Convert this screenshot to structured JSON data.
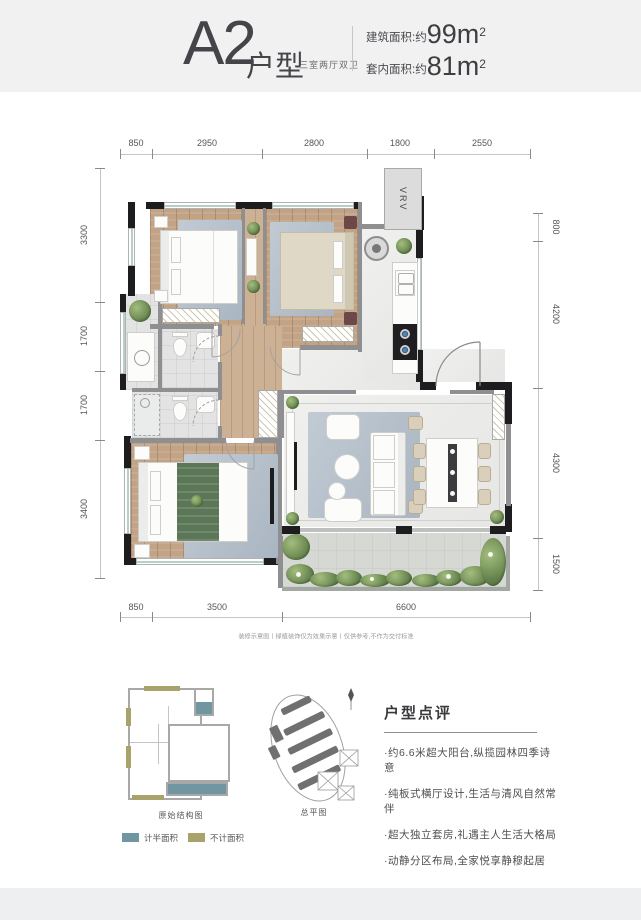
{
  "header": {
    "title": "A2",
    "title_suffix": "户型",
    "subtitle": "三室两厅双卫",
    "area_items": [
      {
        "label": "建筑面积:约",
        "value": "99m",
        "sup": "2"
      },
      {
        "label": "套内面积:约",
        "value": "81m",
        "sup": "2"
      }
    ]
  },
  "plan": {
    "vrv_label": "VRV",
    "dims_top": [
      "850",
      "2950",
      "2800",
      "1800",
      "2550"
    ],
    "dims_left": [
      "3300",
      "1700",
      "1700",
      "3400"
    ],
    "dims_right": [
      "800",
      "4200",
      "4300",
      "1500"
    ],
    "dims_bottom": [
      "850",
      "3500",
      "6600"
    ],
    "disclaimer": "装修示意图丨绿植装饰仅为效果示意丨仅供参考,不作为交付标准"
  },
  "footer": {
    "structure_label": "原始结构图",
    "site_label": "总平图",
    "legend": [
      {
        "label": "计半面积",
        "color": "#7097a1"
      },
      {
        "label": "不计面积",
        "color": "#a9a26b"
      }
    ],
    "review_title": "户型点评",
    "review_bullets": [
      "·约6.6米超大阳台,纵揽园林四季诗意",
      "·纯板式横厅设计,生活与清风自然常伴",
      "·超大独立套房,礼遇主人生活大格局",
      "·动静分区布局,全家悦享静穆起居"
    ]
  },
  "colors": {
    "accent_teal": "#7097a1",
    "accent_olive": "#a9a26b",
    "wall": "#1d1d1f"
  }
}
